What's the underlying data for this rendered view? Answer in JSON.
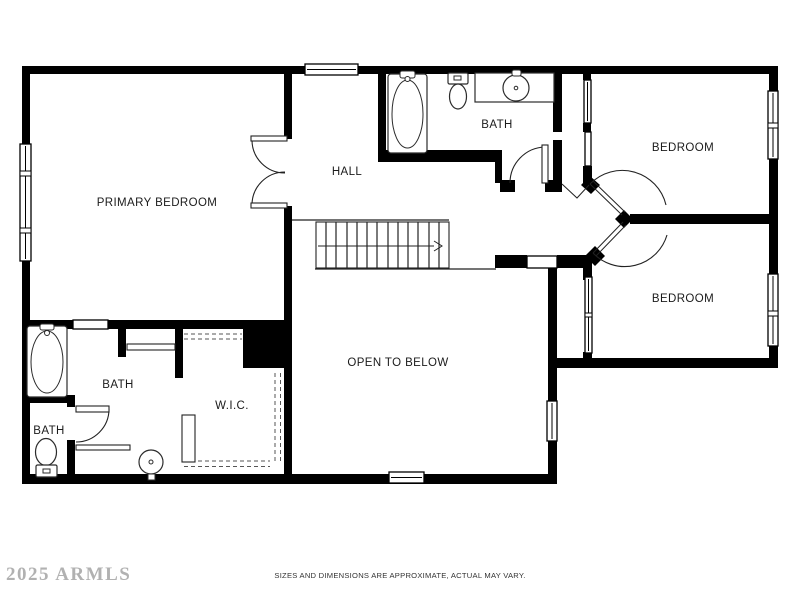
{
  "page": {
    "background": "#ffffff",
    "wall_color": "#000000",
    "watermark": "2025 ARMLS",
    "disclaimer": "SIZES AND DIMENSIONS ARE APPROXIMATE, ACTUAL MAY VARY."
  },
  "floorplan": {
    "type": "second-floor residential plan",
    "rooms": [
      {
        "id": "primary-bedroom",
        "label": "PRIMARY BEDROOM"
      },
      {
        "id": "hall",
        "label": "HALL"
      },
      {
        "id": "bath-upper",
        "label": "BATH"
      },
      {
        "id": "bedroom-top-right",
        "label": "BEDROOM"
      },
      {
        "id": "bedroom-bottom-right",
        "label": "BEDROOM"
      },
      {
        "id": "bath-primary",
        "label": "BATH"
      },
      {
        "id": "bath-small",
        "label": "BATH"
      },
      {
        "id": "wic",
        "label": "W.I.C."
      },
      {
        "id": "open-to-below",
        "label": "OPEN TO BELOW"
      }
    ],
    "fixtures": [
      "bathtub",
      "toilet",
      "vanity-sink",
      "bathtub",
      "pedestal-sink",
      "toilet"
    ],
    "features": [
      "staircase-with-direction-arrow",
      "french-doors",
      "angled-bedroom-doors",
      "closets",
      "windows"
    ]
  }
}
